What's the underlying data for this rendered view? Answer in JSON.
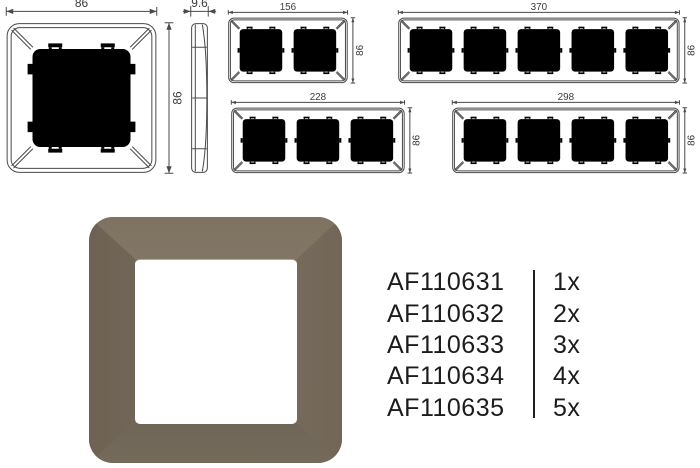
{
  "drawings": {
    "one_gang": {
      "width_label": "86",
      "height_label": "86"
    },
    "side_profile": {
      "thickness_label": "9.6"
    },
    "two_gang": {
      "width_label": "156",
      "height_label": "86"
    },
    "five_gang": {
      "width_label": "370",
      "height_label": "86"
    },
    "three_gang": {
      "width_label": "228",
      "height_label": "86"
    },
    "four_gang": {
      "width_label": "298",
      "height_label": "86"
    }
  },
  "product_photo": {
    "frame_base_color": "#7b7061",
    "frame_top_color": "#8a7d6b",
    "frame_left_color": "#6e6355",
    "frame_right_color": "#857a6a",
    "frame_bottom_color": "#665c4d",
    "window_color": "#ffffff"
  },
  "products": [
    {
      "code": "AF110631",
      "quantity": "1x"
    },
    {
      "code": "AF110632",
      "quantity": "2x"
    },
    {
      "code": "AF110633",
      "quantity": "3x"
    },
    {
      "code": "AF110634",
      "quantity": "4x"
    },
    {
      "code": "AF110635",
      "quantity": "5x"
    }
  ]
}
